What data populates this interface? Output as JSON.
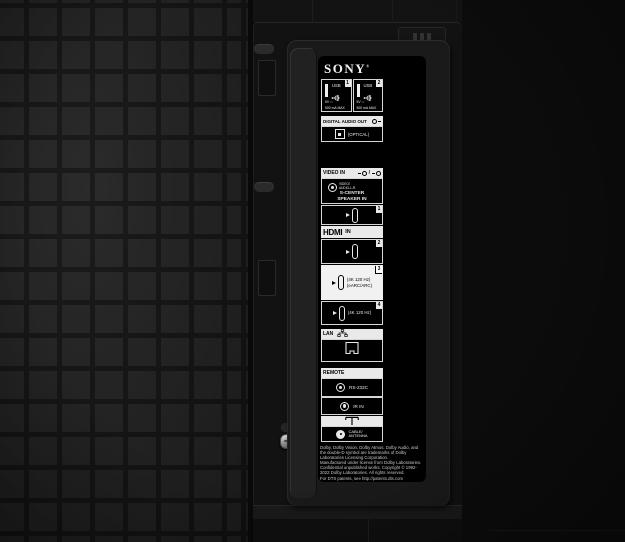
{
  "brand": {
    "logo": "SONY",
    "reg": "®"
  },
  "panel": {
    "usb": [
      {
        "num": "1",
        "label": "USB",
        "power": "5V ⎓",
        "current": "500 mA MAX"
      },
      {
        "num": "2",
        "label": "USB",
        "power": "5V ⎓",
        "current": "500 mA MAX"
      }
    ],
    "digital_audio": {
      "header": "DIGITAL AUDIO OUT",
      "optical": "(OPTICAL)"
    },
    "video_in": {
      "header": "VIDEO IN",
      "jack_line1": "VIDEO/",
      "jack_line2": "AUDIO-L-R",
      "sub_line1": "S-CENTER",
      "sub_line2": "SPEAKER IN"
    },
    "hdmi1": {
      "num": "1"
    },
    "hdmi_header": {
      "logo": "HDMI",
      "suffix": "IN"
    },
    "hdmi2": {
      "num": "2"
    },
    "hdmi3": {
      "num": "3",
      "line1": "(4K 120 Hz)",
      "line2": "(eARC/ARC)"
    },
    "hdmi4": {
      "num": "4",
      "line1": "(4K 120 Hz)"
    },
    "lan": {
      "header": "LAN"
    },
    "remote": {
      "header": "REMOTE",
      "rs232c": "RS-232C",
      "ir_in": "IR IN"
    },
    "cable": {
      "line1": "CABLE/",
      "line2": "ANTENNA"
    },
    "legal": "Dolby, Dolby Vision, Dolby Atmos, Dolby Audio, and\nthe double-D symbol are trademarks of Dolby\nLaboratories Licensing Corporation.\nManufactured under license from Dolby Laboratories.\nConfidential unpublished works. Copyright © 1992-\n2022 Dolby Laboratories. All rights reserved.\nFor DTS patents, see http://patents.dts.com"
  },
  "icons": {
    "usb": "usb-trident-icon",
    "audio_out": "audio-out-jack-icon",
    "optical": "optical-port-icon",
    "video_jack": "rca-jack-icon",
    "minijack": "minijack-icon",
    "hdmi_port": "hdmi-port-icon",
    "network": "lan-network-icon",
    "lan_port": "ethernet-port-icon",
    "antenna": "antenna-symbol-icon",
    "coax": "coax-connector-icon"
  },
  "colors": {
    "body": "#0c0c0c",
    "tile": "#242424",
    "tile_seam": "#141414",
    "cover": "#1a1a1a",
    "label_panel_bg": "#000000",
    "label_fg": "#e8e8e8",
    "highlight_box": "#f1f1f1"
  }
}
